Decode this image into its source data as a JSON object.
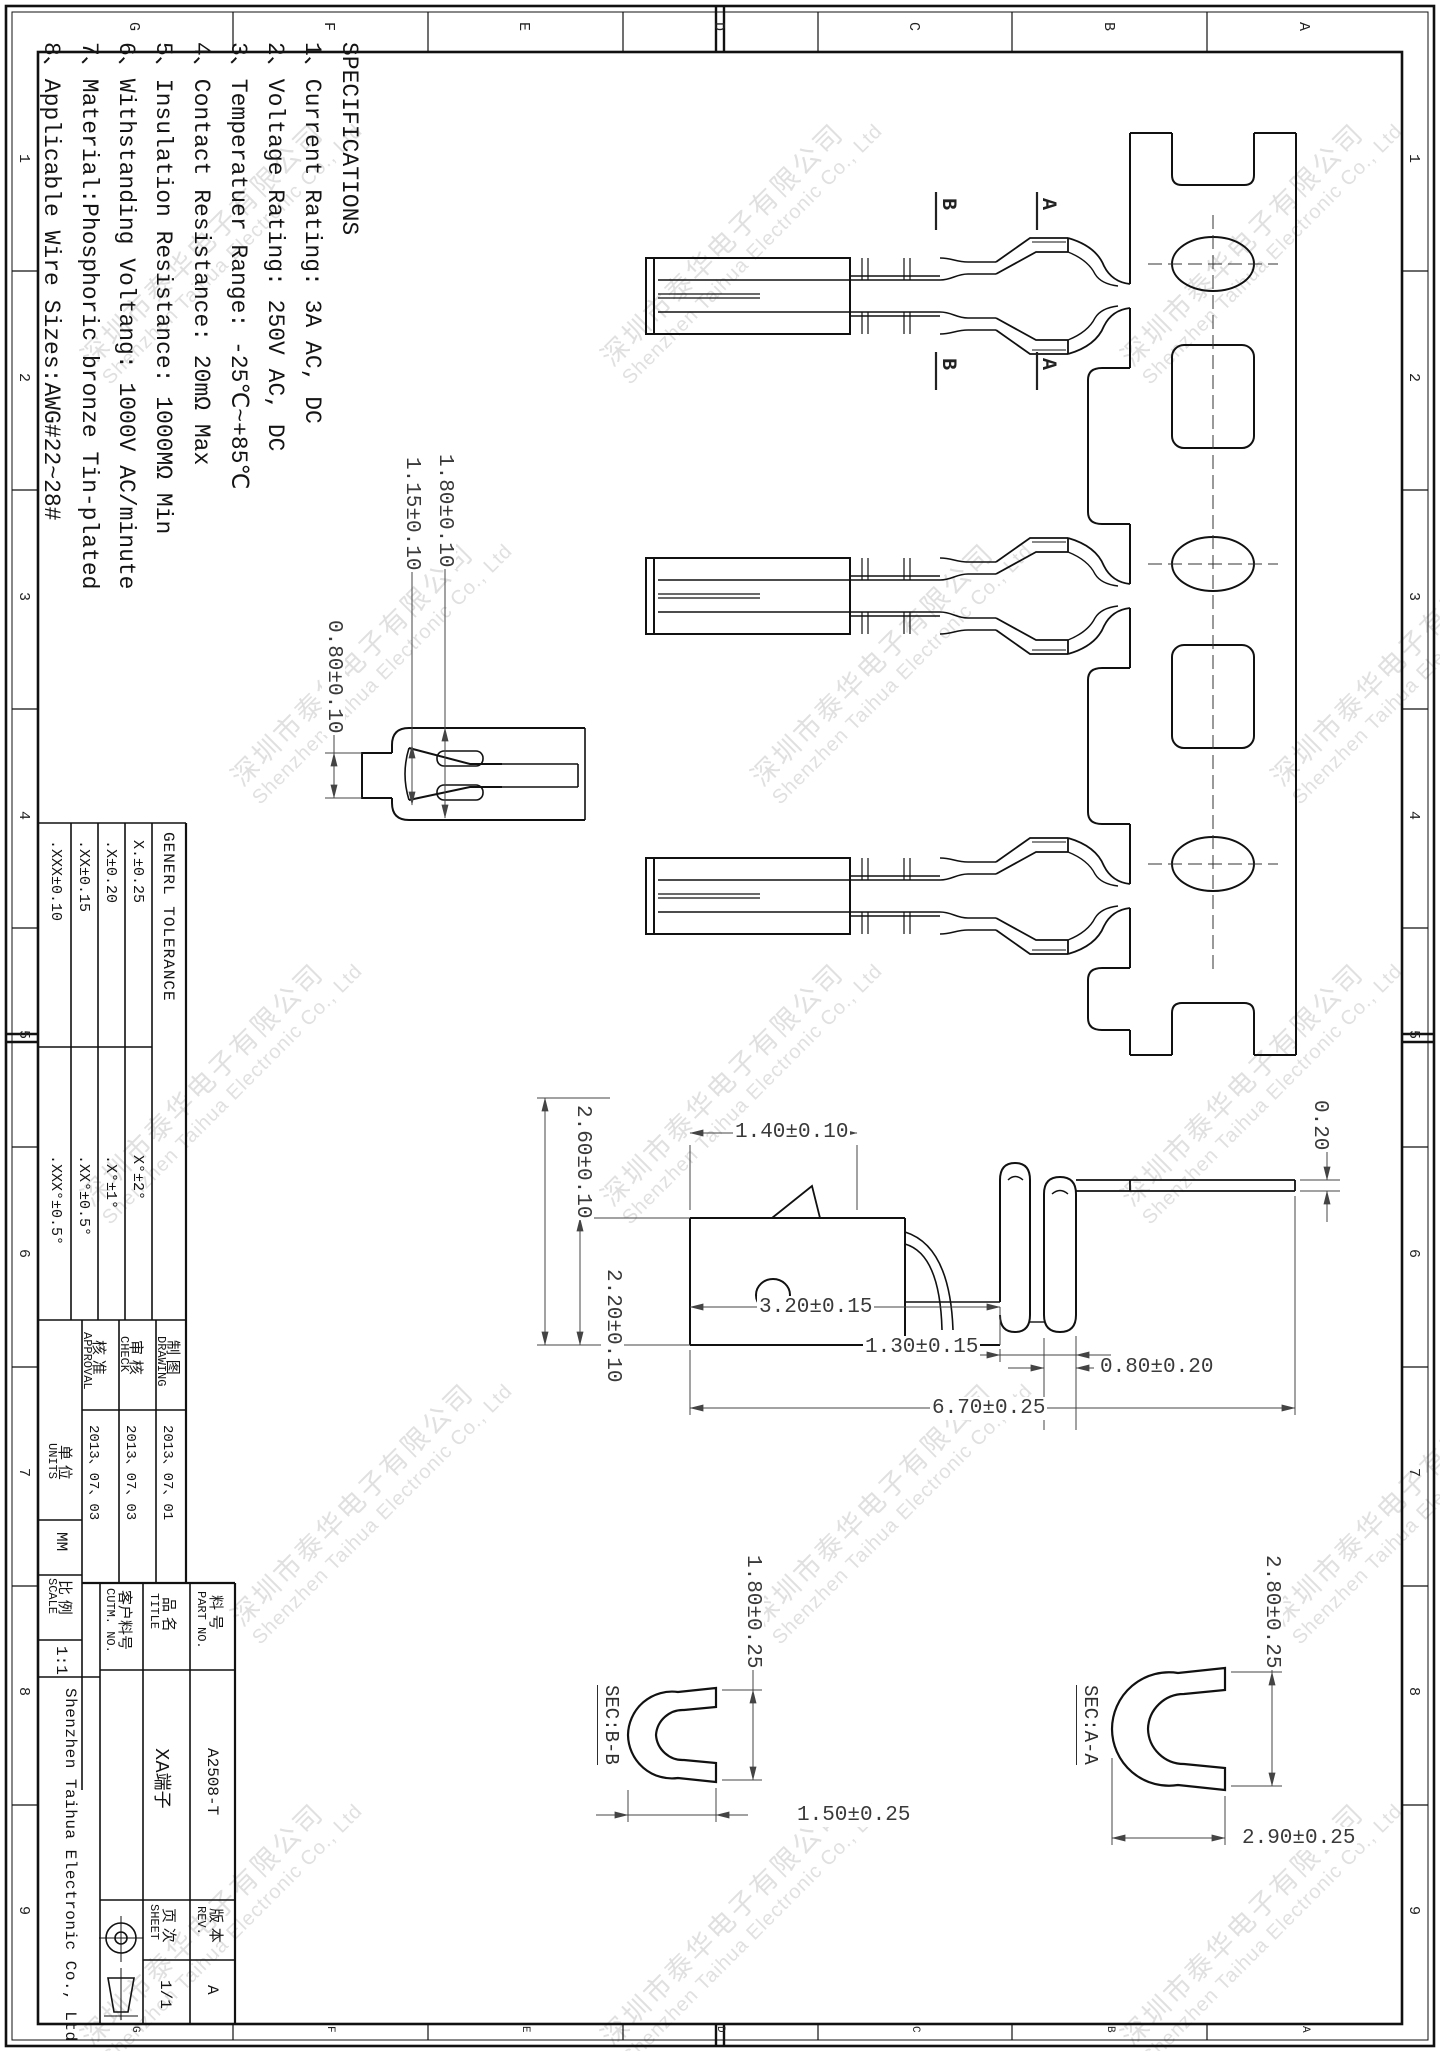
{
  "sheet": {
    "zone_numbers": [
      "1",
      "2",
      "3",
      "4",
      "5",
      "6",
      "7",
      "8",
      "9"
    ],
    "zone_letters": [
      "G",
      "F",
      "E",
      "D",
      "C",
      "B",
      "A"
    ]
  },
  "watermark": {
    "line1": "深圳市泰华电子有限公司",
    "line2": "Shenzhen Taihua Electronic Co., Ltd"
  },
  "specs": {
    "title": "SPECIFICATIONS",
    "lines": [
      "1、Current Rating: 3A AC, DC",
      "2、Voltage Rating: 250V AC, DC",
      "3、Temperatuer Range: -25℃~+85℃",
      "4、Contact Resistance: 20mΩ Max",
      "5、Insulation Resistance: 1000MΩ Min",
      "6、Withstanding Voltang: 1000V AC/minute",
      "7、Material:Phosphoric bronze Tin-plated",
      "8、Applicable Wire Sizes:AWG#22~28#"
    ]
  },
  "title_block": {
    "tolerance": {
      "header": "GENERL TOLERANCE",
      "rows": [
        {
          "lin": "X.±0.25",
          "ang": "X°±2°"
        },
        {
          "lin": ".X±0.20",
          "ang": ".X°±1°"
        },
        {
          "lin": ".XX±0.15",
          "ang": ".XX°±0.5°"
        },
        {
          "lin": ".XXX±0.10",
          "ang": ".XXX°±0.5°"
        }
      ]
    },
    "signoff": {
      "drawing_zh": "制 图",
      "drawing_en": "DRAWING",
      "drawing_date": "2013、07、01",
      "check_zh": "审 核",
      "check_en": "CHECK",
      "check_date": "2013、07、03",
      "approval_zh": "核 准",
      "approval_en": "APPROVAL",
      "approval_date": "2013、07、03",
      "units_zh": "单 位",
      "units_en": "UNITS",
      "units_value": "MM",
      "scale_zh": "比 例",
      "scale_en": "SCALE",
      "scale_value": "1:1"
    },
    "part": {
      "part_no_zh": "料 号",
      "part_no_en": "PART NO.",
      "part_no_value": "A2508-T",
      "title_zh": "品 名",
      "title_en": "TITLE",
      "title_value": "XA端子",
      "cutm_zh": "客户料号",
      "cutm_en": "CUTM. NO.",
      "cutm_value": "",
      "rev_zh": "版 本",
      "rev_en": "REV.",
      "rev_value": "A",
      "sheet_zh": "页 次",
      "sheet_en": "SHEET",
      "sheet_value": "1/1"
    },
    "company": "Shenzhen Taihua Electronic Co., Ltd"
  },
  "views": {
    "chain": {
      "section_a": "A",
      "section_b": "B"
    },
    "front": {
      "d_slot": "0.80±0.10",
      "d_inner": "1.15±0.10",
      "d_outer": "1.80±0.10"
    },
    "side": {
      "d_lance": "1.40±0.10",
      "d_height": "2.60±0.10",
      "d_box_h": "2.20±0.10",
      "d_box_len": "3.20±0.15",
      "d_gap": "1.30±0.15",
      "d_wing": "0.80±0.20",
      "d_total": "6.70±0.25",
      "d_thk": "0.20"
    },
    "sec_bb": {
      "label": "SEC:B-B",
      "d_h": "1.80±0.25",
      "d_w": "1.50±0.25"
    },
    "sec_aa": {
      "label": "SEC:A-A",
      "d_h": "2.80±0.25",
      "d_w": "2.90±0.25"
    }
  }
}
